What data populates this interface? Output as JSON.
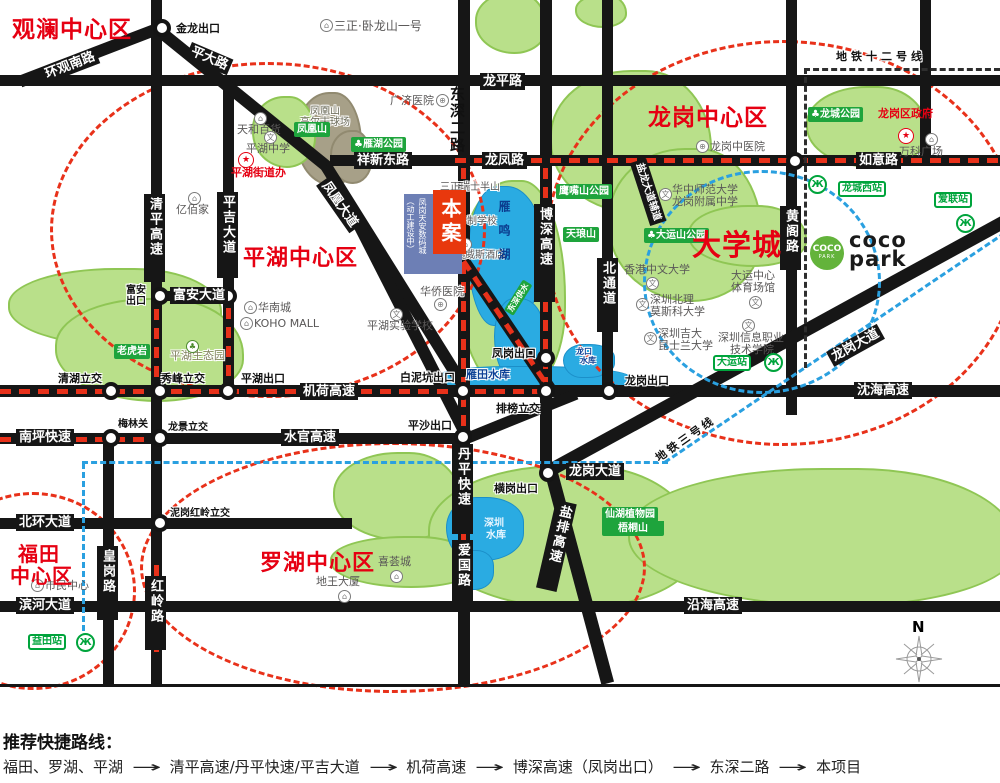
{
  "d": {
    "guanlan": "观澜中心区",
    "longgang": "龙岗中心区",
    "pinghu": "平湖中心区",
    "daxuecheng": "大学城",
    "futian1": "福田",
    "futian2": "中心区",
    "luohu": "罗湖中心区"
  },
  "r": {
    "huanguan": "环观南路",
    "pingda": "平大路",
    "longping": "龙平路",
    "xiangxin": "祥新东路",
    "longfeng": "龙凤路",
    "ruyi": "如意路",
    "fuan": "富安大道",
    "jihe": "机荷高速",
    "nanping": "南坪快速",
    "shuiguan": "水官高速",
    "beihuan": "北环大道",
    "binhe": "滨河大道",
    "yanhai": "沿海高速",
    "shenhai": "沈海高速",
    "lgdd": "龙岗大道",
    "fenghuang": "凤凰大道",
    "yanlong": "盐龙大道辅道",
    "yanpai": "盐排高速",
    "qingping": "清平高速",
    "pingji": "平吉大道",
    "dongshen": "东深二路",
    "boshen": "博深高速",
    "beitong": "北通道",
    "huangge": "黄阁路",
    "danping": "丹平快速",
    "aiguo": "爱国路",
    "huanggang": "皇岗路",
    "hongling": "红岭路"
  },
  "x": {
    "jinlong": "金龙出口",
    "fuan1": "富安",
    "fuan2": "出口",
    "qinghu": "清湖立交",
    "xiufeng": "秀峰立交",
    "pinghu": "平湖出口",
    "bainikeng": "白泥坑出口",
    "fenggang": "凤岗出口",
    "longgang": "龙岗出口",
    "pailou": "排榜立交",
    "pingsha": "平沙出口",
    "henggang": "横岗出口",
    "meilin": "梅林关",
    "longjing": "龙景立交",
    "nigang": "泥岗红岭立交"
  },
  "p": {
    "sz1": "三正·卧龙山一号",
    "fhs1": "凤凰山",
    "fhs2": "高尔夫球场",
    "tianhe": "天和百货",
    "phzx": "平湖中学",
    "phjdb": "平湖街道办",
    "ybj": "亿佰家",
    "hnc": "华南城",
    "koho": "KOHO MALL",
    "gjyy": "广济医院",
    "lgzyy": "龙岗中医院",
    "lgzf": "龙岗区政府",
    "wk": "万科广场",
    "hz1": "华中师范大学",
    "hz2": "龙岗附属中学",
    "dyzx1": "大运中心",
    "dyzx2": "体育场馆",
    "hk": "香港中文大学",
    "bl1": "深圳北理",
    "bl2": "莫斯科大学",
    "jd1": "深圳吉大",
    "jd2": "昆士兰大学",
    "xx1": "深圳信息职业",
    "xx2": "技术学院",
    "smzx": "市民中心",
    "xhc": "喜荟城",
    "dwds": "地王大厦",
    "hqyy": "华侨医院",
    "physy": "平湖实验学校",
    "jnz": "九年制学校",
    "aws": "奥威斯酒店",
    "szrs": "三正瑞士半山",
    "pheco": "平湖生态园"
  },
  "g": {
    "fhshan": "凤凰山",
    "yanhu": "雁湖公园",
    "yzs": "鹰嘴山公园",
    "tls": "天琅山",
    "dys": "大运山公园",
    "lcgy": "龙城公园",
    "lhy": "老虎岩",
    "xianhu1": "仙湖植物园",
    "xianhu2": "梧桐山",
    "dsgs": "东深供水"
  },
  "l": {
    "ym": "雁鸣湖",
    "yt": "雁田水库",
    "sz1": "深圳",
    "sz2": "水库",
    "lk1": "龙口",
    "lk2": "水库"
  },
  "m": {
    "l12": "地铁十二号线",
    "l3": "地铁三号线",
    "lcx": "龙城西站",
    "al": "爱联站",
    "dy": "大运站",
    "ytz": "益田站"
  },
  "prj": {
    "ba": "本案",
    "c1": "（动工建设中）",
    "c2": "凤岗天安数码城"
  },
  "coco": {
    "c1": "COCO",
    "c2": "PARK",
    "t1": "coco",
    "t2": "park"
  },
  "compass": {
    "n": "N"
  },
  "icons": {
    "tree": "♣",
    "hospital": "⊕",
    "school": "文",
    "building": "⌂",
    "star": "★",
    "metro": "Ж"
  },
  "route": {
    "title": "推荐快捷路线：",
    "arrow": "→",
    "s0": "福田、罗湖、平湖",
    "s1": "清平高速/丹平快速/平吉大道",
    "s2": "机荷高速",
    "s3": "博深高速（凤岗出口）",
    "s4": "东深二路",
    "s5": "本项目"
  }
}
